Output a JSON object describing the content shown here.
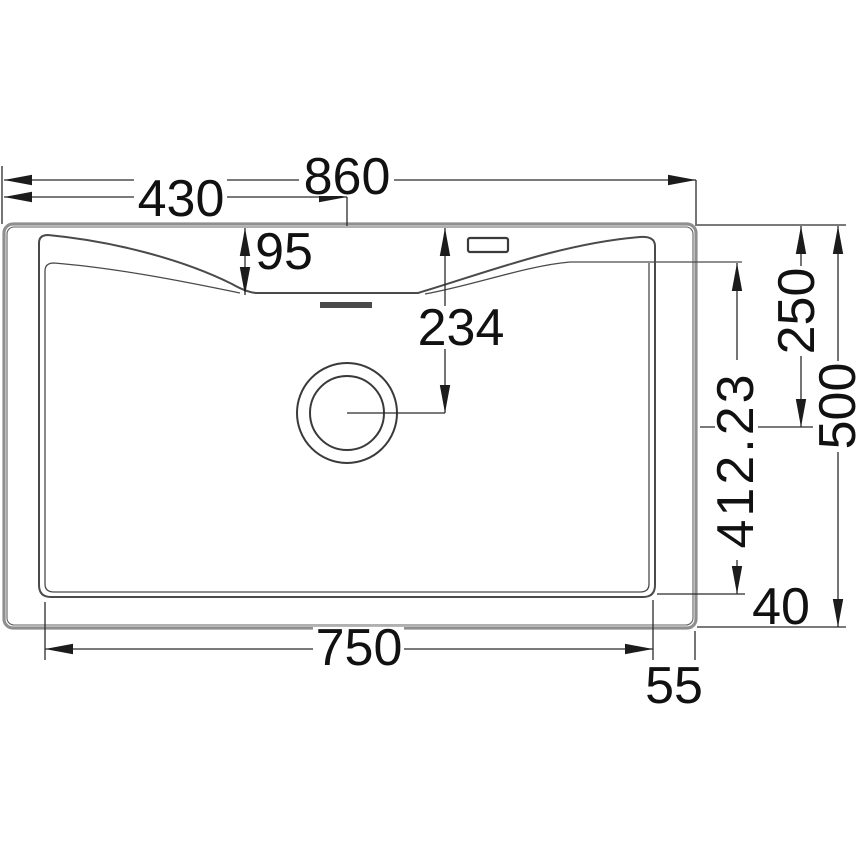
{
  "drawing": {
    "title": "Sink installation dimension drawing (top view)",
    "units": "mm"
  },
  "dims": {
    "overall_width": "860",
    "center_from_left": "430",
    "front_ledge_drop": "95",
    "drain_center_from_top": "234",
    "upper_right_offset": "250",
    "overall_depth": "500",
    "bowl_inner_depth": "412.23",
    "bottom_gap": "40",
    "bowl_width": "750",
    "side_gap": "55"
  },
  "colors": {
    "background": "#ffffff",
    "dimension_line": "#2b2b2b",
    "arrow": "#1c1c1c",
    "text": "#111111",
    "body_outline": "#8f8f8f",
    "body_accent": "#606060",
    "basin_line": "#4a4a4a"
  }
}
